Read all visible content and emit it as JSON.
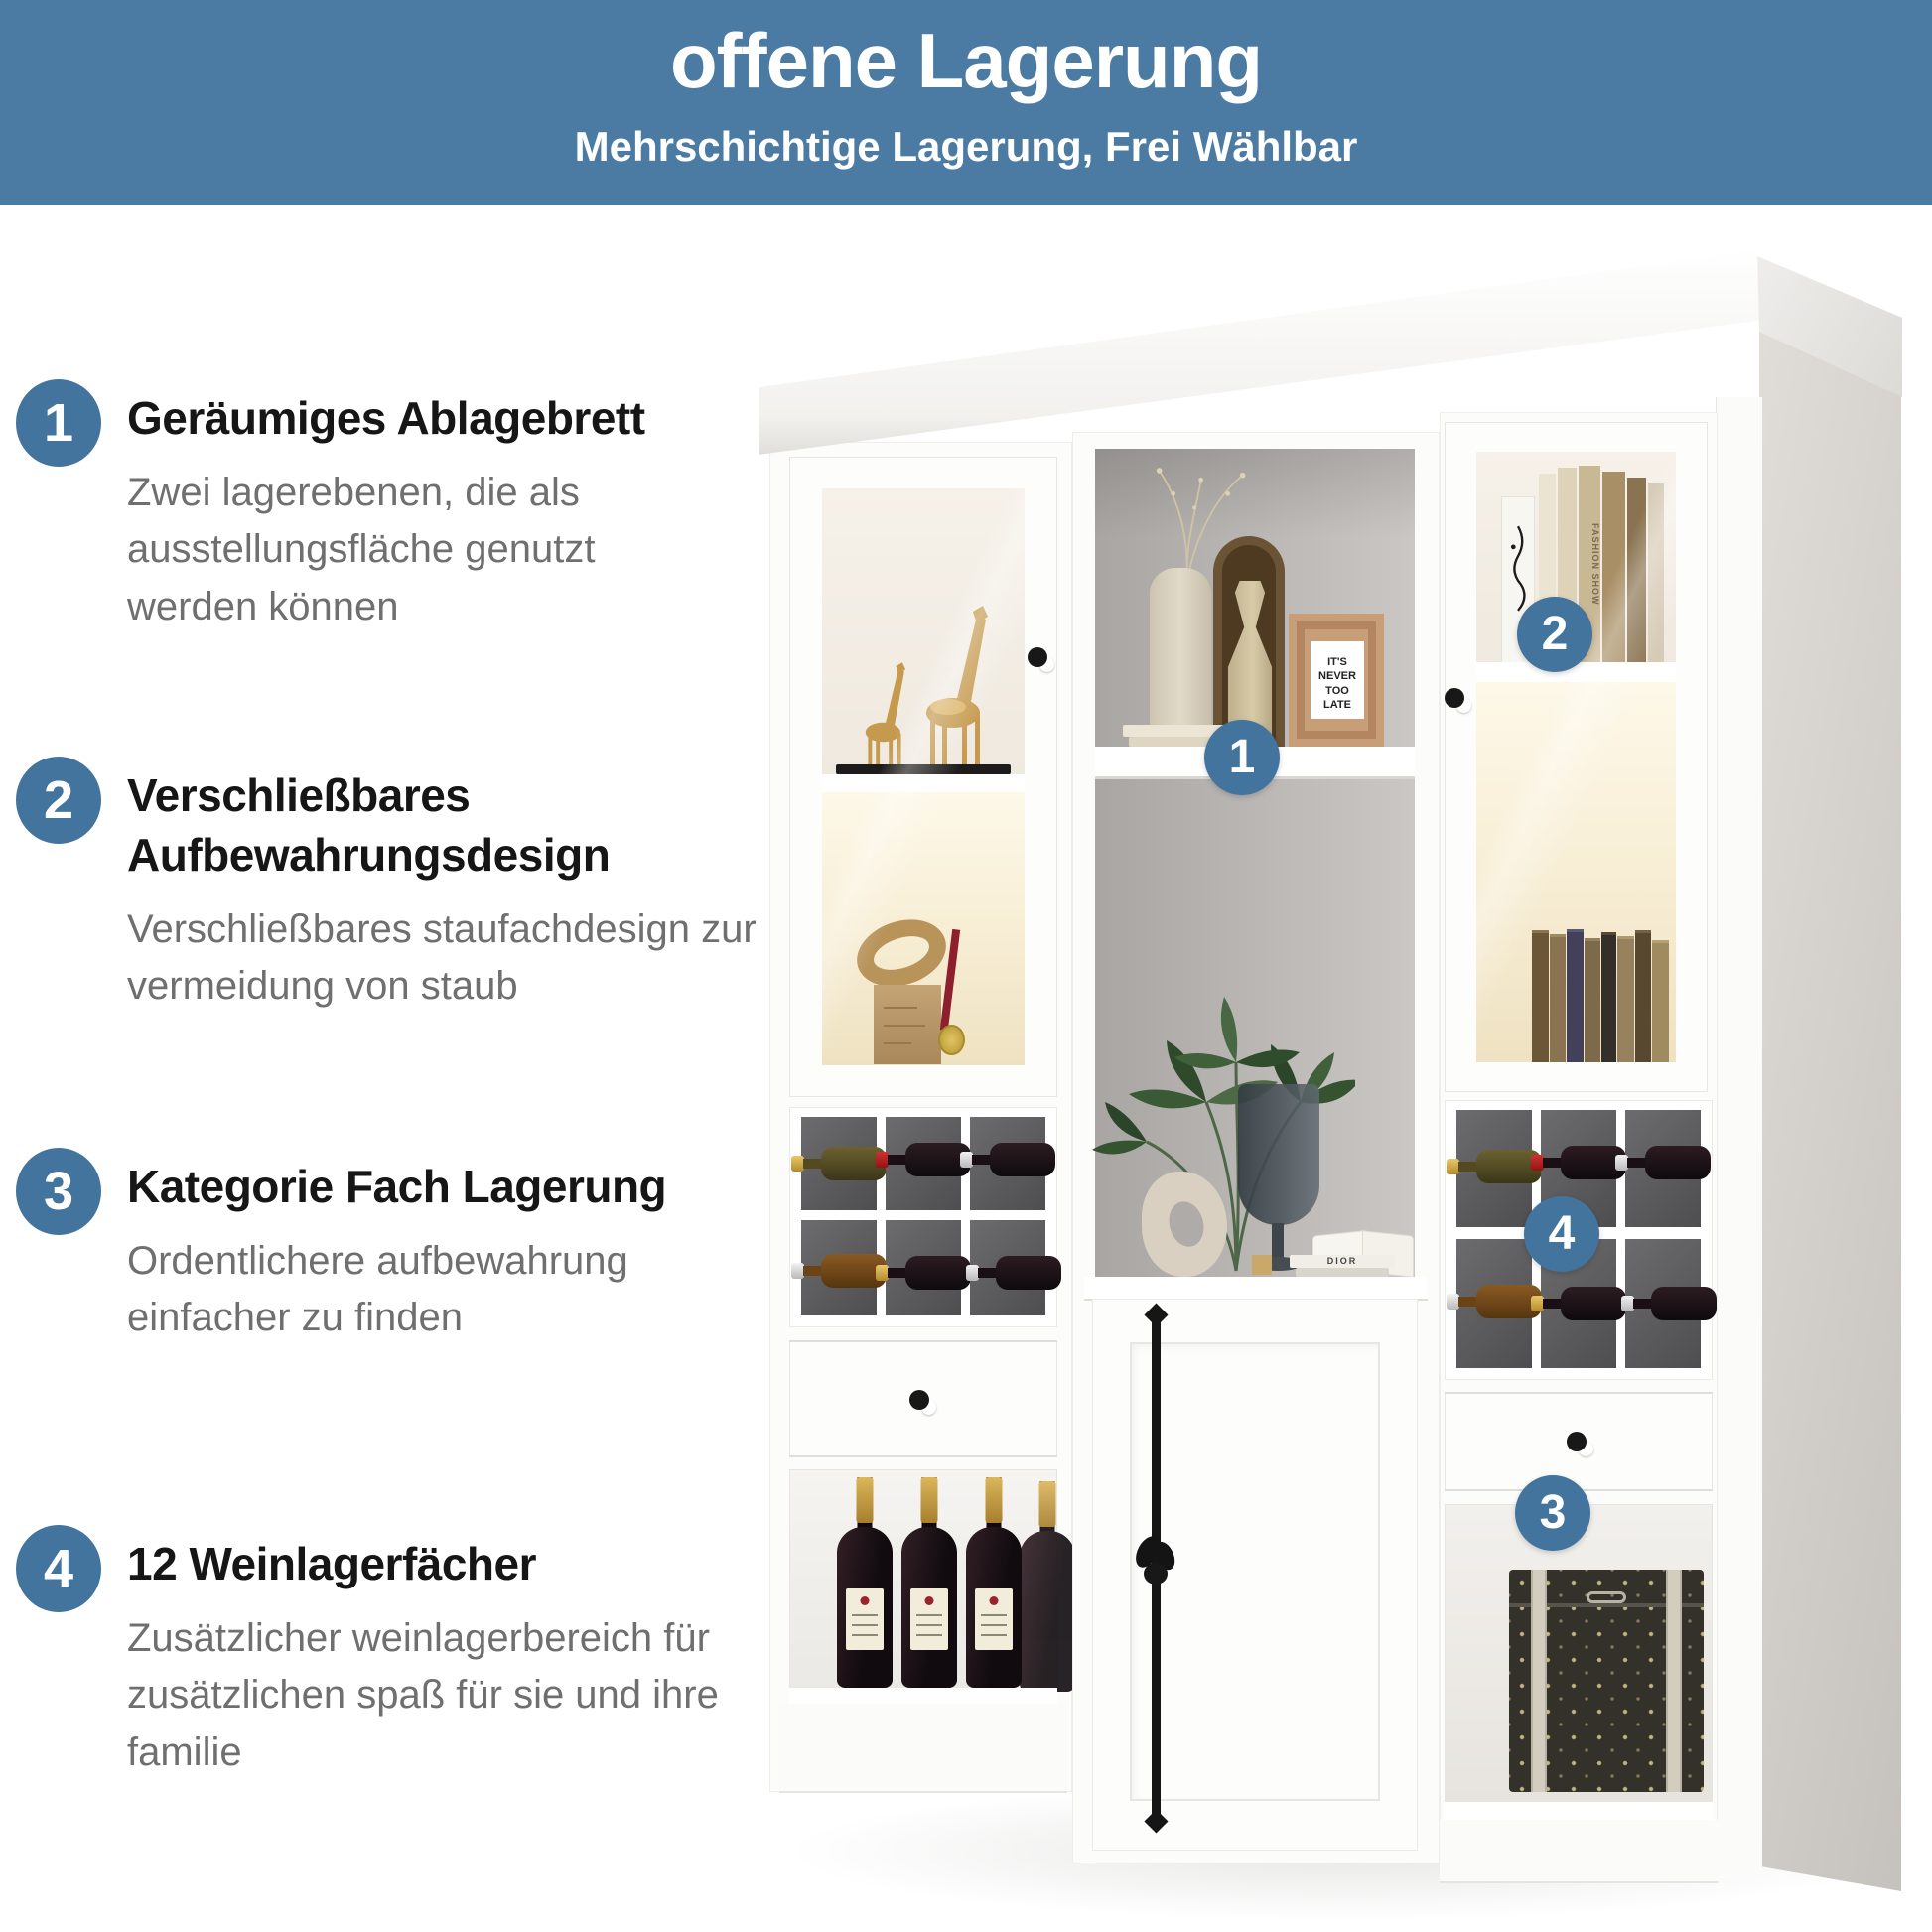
{
  "header": {
    "title": "offene Lagerung",
    "subtitle": "Mehrschichtige Lagerung, Frei Wählbar"
  },
  "features": [
    {
      "number": "1",
      "title": "Geräumiges Ablagebrett",
      "description": "Zwei lagerebenen, die als ausstellungsfläche genutzt werden können"
    },
    {
      "number": "2",
      "title": "Verschließbares Aufbewahrungsdesign",
      "description": "Verschließbares staufachdesign zur vermeidung von staub"
    },
    {
      "number": "3",
      "title": "Kategorie Fach Lagerung",
      "description": "Ordentlichere aufbewahrung einfacher zu finden"
    },
    {
      "number": "4",
      "title": "12 Weinlagerfächer",
      "description": "Zusätzlicher weinlagerbereich für zusätzlichen spaß für sie und ihre familie"
    }
  ],
  "cabinet": {
    "callouts": [
      {
        "id": "display-shelf",
        "number": "1"
      },
      {
        "id": "glass-door",
        "number": "2"
      },
      {
        "id": "category-drawer",
        "number": "3"
      },
      {
        "id": "wine-rack",
        "number": "4"
      }
    ],
    "decor": {
      "frame_text": "IT'S\nNEVER\nTOO\nLATE",
      "fashion_book_spine": "FASHION SHOW",
      "dior_book_spine": "DIOR"
    }
  },
  "colors": {
    "accent_blue": "#4b7ba3",
    "badge_blue": "#42749d",
    "title_text": "#161616",
    "description_text": "#6f6f6f",
    "warm_glow": "#f7ecd2",
    "interior_gray": "#b3b0ad",
    "cubby_gray": "#5d5d5f"
  }
}
